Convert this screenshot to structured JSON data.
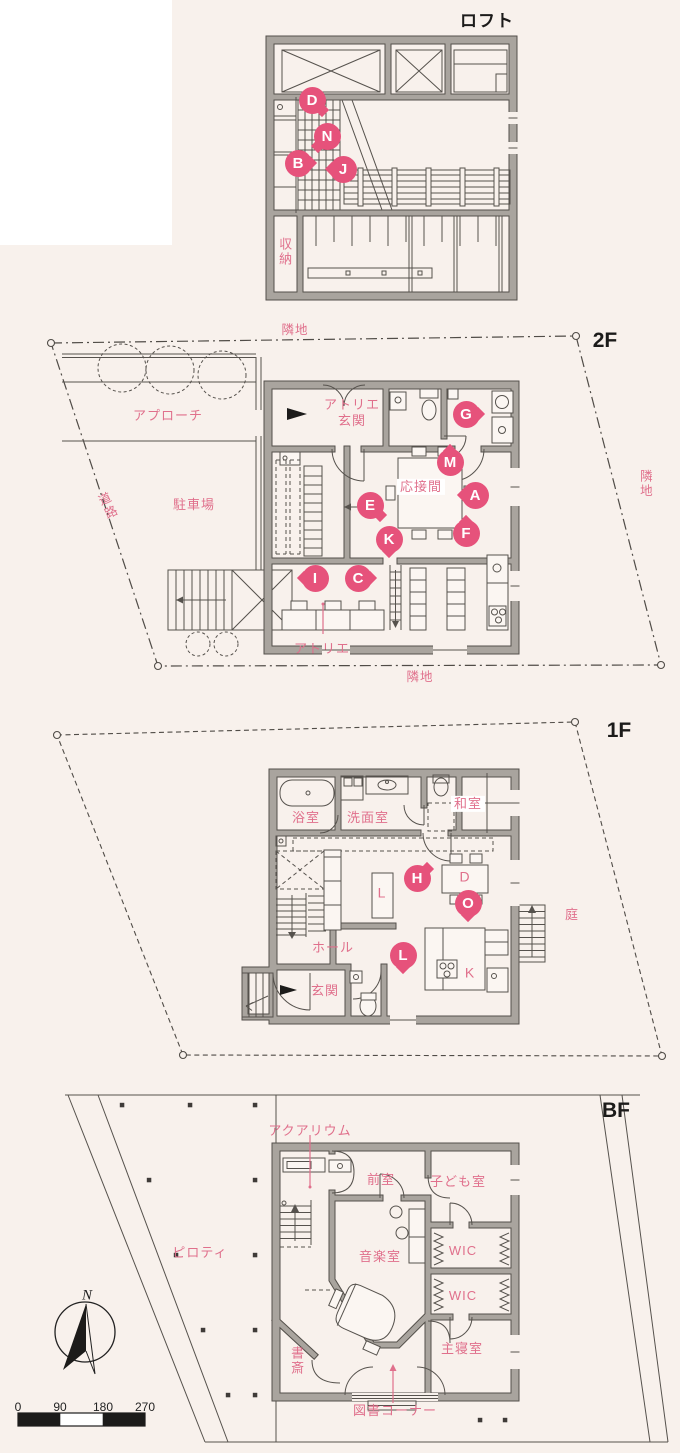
{
  "colors": {
    "background": "#f8f1ec",
    "panel_white": "#ffffff",
    "wall_gray": "#a9a49e",
    "wall_edge": "#54504b",
    "thin_line": "#56524d",
    "label_pink": "#e0708c",
    "marker_pink": "#e6527b",
    "title_black": "#1c1b1a"
  },
  "floors": {
    "loft": {
      "title": "ロフト",
      "labels": {
        "storage": "収納"
      },
      "markers": {
        "d": "D",
        "n": "N",
        "b": "B",
        "j": "J"
      }
    },
    "f2": {
      "title": "2F",
      "labels": {
        "adjacent_top": "隣地",
        "adjacent_right": "隣地",
        "adjacent_bottom": "隣地",
        "road": "道路",
        "approach": "アプローチ",
        "parking": "駐車場",
        "atelier_entrance_line1": "アトリエ",
        "atelier_entrance_line2": "玄関",
        "reception_room": "応接間",
        "atelier": "アトリエ"
      },
      "markers": {
        "g": "G",
        "m": "M",
        "a": "A",
        "e": "E",
        "f": "F",
        "k": "K",
        "i": "I",
        "c": "C"
      }
    },
    "f1": {
      "title": "1F",
      "labels": {
        "bathroom": "浴室",
        "washroom": "洗面室",
        "japanese_room": "和室",
        "living": "L",
        "dining": "D",
        "kitchen": "K",
        "hall": "ホール",
        "entrance": "玄関",
        "garden": "庭"
      },
      "markers": {
        "h": "H",
        "o": "O",
        "l": "L"
      }
    },
    "bf": {
      "title": "BF",
      "labels": {
        "aquarium": "アクアリウム",
        "anteroom": "前室",
        "kids_room": "子ども室",
        "piloti": "ピロティ",
        "music_room": "音楽室",
        "wic_upper": "WIC",
        "wic_lower": "WIC",
        "master_bedroom": "主寝室",
        "study": "書斎",
        "library_corner": "図書コーナー"
      }
    }
  },
  "compass": {
    "north": "N"
  },
  "scale_bar": {
    "ticks": [
      "0",
      "90",
      "180",
      "270"
    ]
  }
}
